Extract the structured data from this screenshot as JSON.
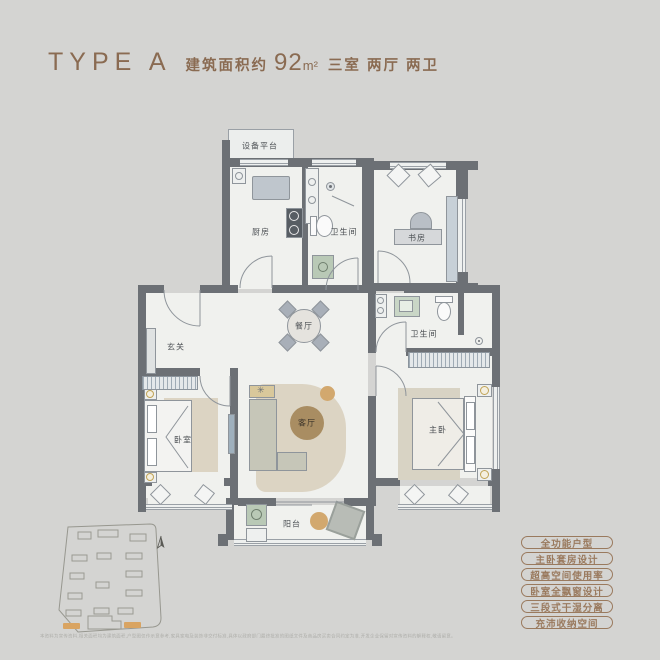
{
  "header": {
    "type_label": "TYPE A",
    "area_prefix": "建筑面积约",
    "area_value": "92",
    "area_unit": "m²",
    "layout_desc": "三室 两厅 两卫"
  },
  "rooms": {
    "equipment_platform": "设备平台",
    "kitchen": "厨房",
    "bathroom1": "卫生间",
    "study": "书房",
    "dining": "餐厅",
    "foyer": "玄关",
    "bedroom": "卧室",
    "living": "客厅",
    "master": "主卧",
    "bathroom2": "卫生间",
    "balcony": "阳台"
  },
  "features": [
    "全功能户型",
    "主卧套房设计",
    "超高空间使用率",
    "卧室全飘窗设计",
    "三段式干湿分离",
    "充沛收纳空间"
  ],
  "icons": {
    "north_arrow": "north-arrow",
    "site_plan": "site-plan-sketch"
  },
  "disclaimer": "本资料为宣传资料,相关面积均为建筑面积,户型图仅作示意参考,家具家电及装饰非交付标准,具体以政府部门最终批准的图纸文件及商品房买卖合同约定为准,开发企业保留对宣传资料的解释权,敬请留意。",
  "colors": {
    "accent_brown": "#8a6b52",
    "tag_brown": "#9a7a5e",
    "wall_gray": "#6c7075",
    "floor_light": "#f0f1ee",
    "bg": "#d4d4d2",
    "rug_beige": "#dcd4c3",
    "table_brown": "#a98d62",
    "tan": "#d2a86e",
    "green_appliance": "#b9c9b6",
    "site_orange": "#d9a462"
  }
}
